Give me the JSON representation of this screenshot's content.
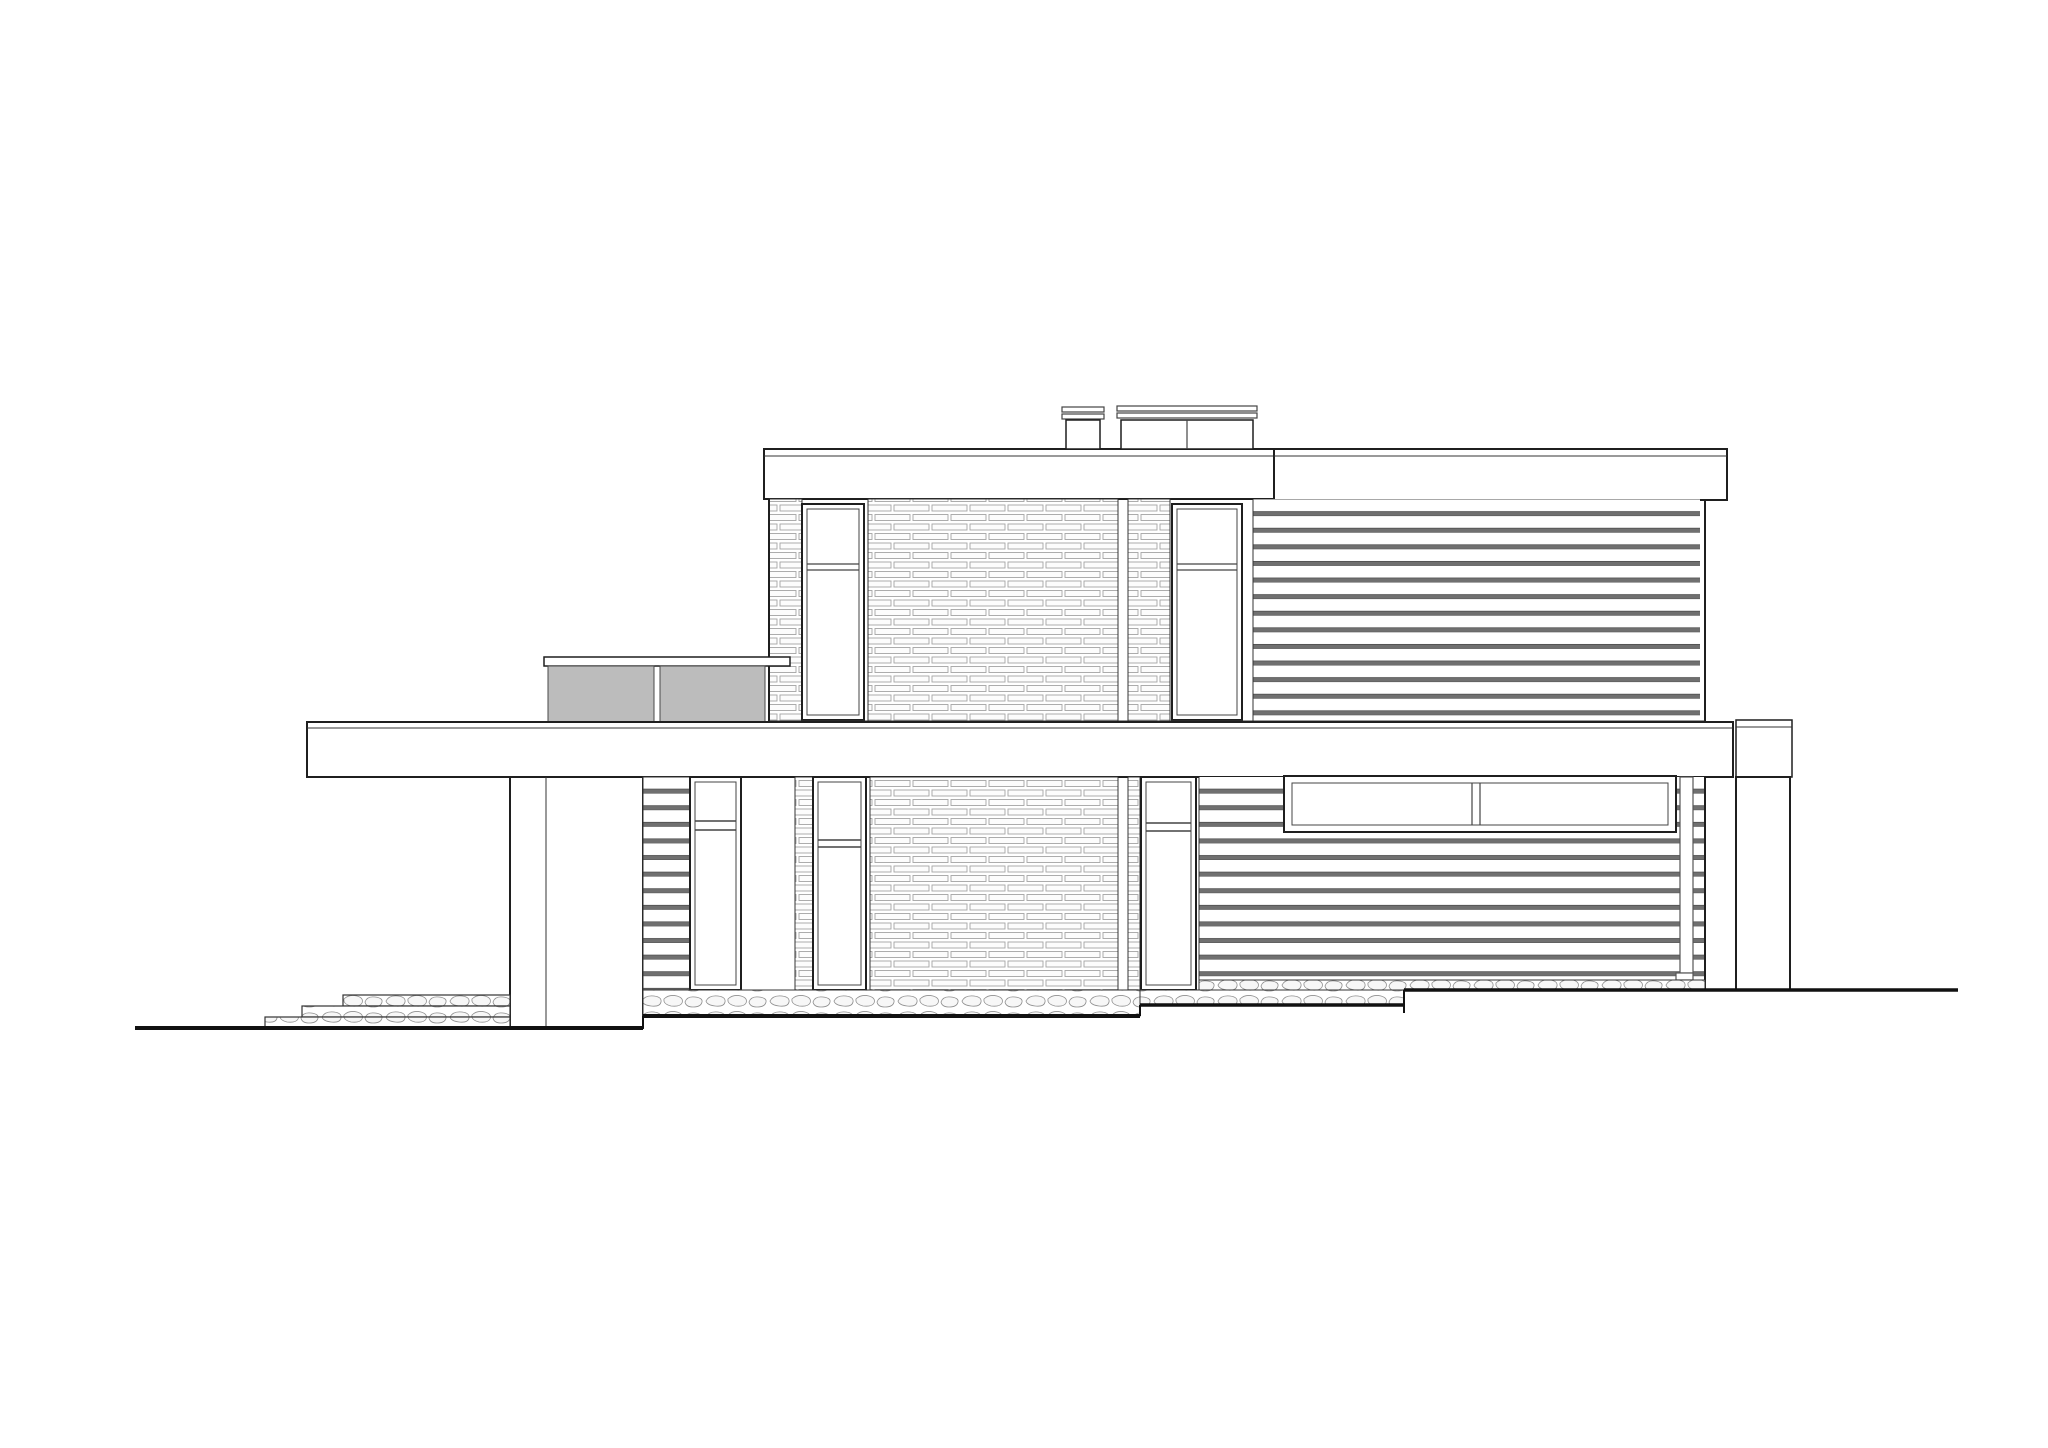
{
  "drawing": {
    "type": "architectural-elevation",
    "subject": "two-story flat-roof modern house side elevation with brick and horizontal siding facades",
    "background": "#ffffff"
  },
  "canvas": {
    "width": 2048,
    "height": 1448
  },
  "colors": {
    "white": "#ffffff",
    "none": "none",
    "dark": "#1f1f1f",
    "mid": "#444444",
    "light": "#333333",
    "pipe": "#555555",
    "ground": "#111111",
    "rail": "#bcbcbc",
    "railStroke": "#4a4a4a",
    "brickLine": "#a3a3a3",
    "brickFill": "#fcfcfc",
    "sidingBar": "#707070",
    "sidingEdge": "#3f3f3f",
    "stoneLine": "#8f8f8f"
  },
  "shapes": [
    {
      "n": "left-roof-slab",
      "t": "rect",
      "x": 764,
      "y": 449,
      "w": 510,
      "h": 50,
      "f": "white",
      "s": "dark",
      "sw": 2
    },
    {
      "n": "left-roof-edge-line",
      "t": "line",
      "x1": 764,
      "y1": 456,
      "x2": 1274,
      "y2": 456,
      "s": "light",
      "sw": 1
    },
    {
      "n": "right-roof-slab",
      "t": "rect",
      "x": 1274,
      "y": 449,
      "w": 453,
      "h": 51,
      "f": "white",
      "s": "dark",
      "sw": 2
    },
    {
      "n": "right-roof-edge-line",
      "t": "line",
      "x1": 1274,
      "y1": 456,
      "x2": 1727,
      "y2": 456,
      "s": "light",
      "sw": 1
    },
    {
      "n": "chimney-small-cap-upper",
      "t": "rect",
      "x": 1062,
      "y": 407,
      "w": 42,
      "h": 5,
      "f": "white",
      "s": "mid",
      "sw": 1.2
    },
    {
      "n": "chimney-small-cap-lower",
      "t": "rect",
      "x": 1062,
      "y": 414,
      "w": 42,
      "h": 5,
      "f": "white",
      "s": "mid",
      "sw": 1.2
    },
    {
      "n": "chimney-small-body",
      "t": "rect",
      "x": 1066,
      "y": 420,
      "w": 34,
      "h": 29,
      "f": "white",
      "s": "dark",
      "sw": 1.5
    },
    {
      "n": "chimney-wide-cap-upper",
      "t": "rect",
      "x": 1117,
      "y": 406,
      "w": 140,
      "h": 5,
      "f": "white",
      "s": "mid",
      "sw": 1.2
    },
    {
      "n": "chimney-wide-cap-lower",
      "t": "rect",
      "x": 1117,
      "y": 413,
      "w": 140,
      "h": 5,
      "f": "white",
      "s": "mid",
      "sw": 1.2
    },
    {
      "n": "chimney-wide-body",
      "t": "rect",
      "x": 1121,
      "y": 420,
      "w": 132,
      "h": 29,
      "f": "white",
      "s": "dark",
      "sw": 1.5
    },
    {
      "n": "chimney-wide-divider",
      "t": "line",
      "x1": 1187,
      "y1": 420,
      "x2": 1187,
      "y2": 449,
      "s": "mid",
      "sw": 1.2
    },
    {
      "n": "upper-wall-brick-corner-left",
      "t": "rect",
      "x": 769,
      "y": 499,
      "w": 33,
      "h": 223,
      "f": "p:brick",
      "s": "light",
      "sw": 1
    },
    {
      "n": "upper-brick-field",
      "t": "rect",
      "x": 868,
      "y": 499,
      "w": 250,
      "h": 223,
      "f": "p:brick",
      "s": "light",
      "sw": 1
    },
    {
      "n": "upper-brick-pier-narrow",
      "t": "rect",
      "x": 1128,
      "y": 499,
      "w": 42,
      "h": 223,
      "f": "p:brick",
      "s": "light",
      "sw": 1
    },
    {
      "n": "upper-window-left-frame",
      "t": "rect",
      "x": 802,
      "y": 504,
      "w": 62,
      "h": 216,
      "f": "white",
      "s": "dark",
      "sw": 2
    },
    {
      "n": "upper-window-left-inner",
      "t": "rect",
      "x": 807,
      "y": 509,
      "w": 52,
      "h": 206,
      "f": "white",
      "s": "mid",
      "sw": 1
    },
    {
      "n": "upper-window-left-transom-a",
      "t": "line",
      "x1": 807,
      "y1": 564,
      "x2": 859,
      "y2": 564,
      "s": "mid",
      "sw": 1.2
    },
    {
      "n": "upper-window-left-transom-b",
      "t": "line",
      "x1": 807,
      "y1": 570,
      "x2": 859,
      "y2": 570,
      "s": "mid",
      "sw": 1.2
    },
    {
      "n": "upper-window-right-frame",
      "t": "rect",
      "x": 1172,
      "y": 504,
      "w": 70,
      "h": 216,
      "f": "white",
      "s": "dark",
      "sw": 2
    },
    {
      "n": "upper-window-right-inner",
      "t": "rect",
      "x": 1177,
      "y": 509,
      "w": 60,
      "h": 206,
      "f": "white",
      "s": "mid",
      "sw": 1
    },
    {
      "n": "upper-window-right-transom-a",
      "t": "line",
      "x1": 1177,
      "y1": 564,
      "x2": 1237,
      "y2": 564,
      "s": "mid",
      "sw": 1.2
    },
    {
      "n": "upper-window-right-transom-b",
      "t": "line",
      "x1": 1177,
      "y1": 570,
      "x2": 1237,
      "y2": 570,
      "s": "mid",
      "sw": 1.2
    },
    {
      "n": "upper-siding-field",
      "t": "rect",
      "x": 1253,
      "y": 499,
      "w": 447,
      "h": 223,
      "f": "p:sidingU",
      "s": "none",
      "sw": 0
    },
    {
      "n": "upper-siding-left-joint",
      "t": "line",
      "x1": 1253,
      "y1": 499,
      "x2": 1253,
      "y2": 722,
      "s": "light",
      "sw": 1
    },
    {
      "n": "upper-wall-left-edge",
      "t": "line",
      "x1": 769,
      "y1": 499,
      "x2": 769,
      "y2": 722,
      "s": "dark",
      "sw": 2
    },
    {
      "n": "upper-wall-right-edge",
      "t": "line",
      "x1": 1705,
      "y1": 499,
      "x2": 1705,
      "y2": 722,
      "s": "dark",
      "sw": 2
    },
    {
      "n": "upper-wall-bottom-line",
      "t": "line",
      "x1": 769,
      "y1": 721,
      "x2": 1705,
      "y2": 721,
      "s": "light",
      "sw": 1
    },
    {
      "n": "terrace-rail-top-bar",
      "t": "rect",
      "x": 544,
      "y": 657,
      "w": 246,
      "h": 9,
      "f": "white",
      "s": "dark",
      "sw": 1.5
    },
    {
      "n": "terrace-rail-panel-left",
      "t": "rect",
      "x": 548,
      "y": 666,
      "w": 106,
      "h": 56,
      "f": "rail",
      "s": "railStroke",
      "sw": 1
    },
    {
      "n": "terrace-rail-panel-right",
      "t": "rect",
      "x": 660,
      "y": 666,
      "w": 105,
      "h": 56,
      "f": "rail",
      "s": "railStroke",
      "sw": 1
    },
    {
      "n": "mid-floor-slab",
      "t": "rect",
      "x": 307,
      "y": 722,
      "w": 1426,
      "h": 55,
      "f": "white",
      "s": "dark",
      "sw": 2
    },
    {
      "n": "mid-floor-slab-top-line",
      "t": "line",
      "x1": 307,
      "y1": 728,
      "x2": 1733,
      "y2": 728,
      "s": "light",
      "sw": 1
    },
    {
      "n": "mid-floor-slab-right-piece",
      "t": "rect",
      "x": 1736,
      "y": 720,
      "w": 56,
      "h": 57,
      "f": "white",
      "s": "dark",
      "sw": 1.5
    },
    {
      "n": "mid-floor-slab-right-line",
      "t": "line",
      "x1": 1736,
      "y1": 727,
      "x2": 1792,
      "y2": 727,
      "s": "light",
      "sw": 1
    },
    {
      "n": "lower-pier-left",
      "t": "rect",
      "x": 510,
      "y": 777,
      "w": 133,
      "h": 251,
      "f": "white",
      "s": "dark",
      "sw": 2
    },
    {
      "n": "lower-pier-left-corner",
      "t": "line",
      "x1": 546,
      "y1": 777,
      "x2": 546,
      "y2": 1028,
      "s": "light",
      "sw": 1
    },
    {
      "n": "lower-siding-strip",
      "t": "rect",
      "x": 643,
      "y": 777,
      "w": 47,
      "h": 213,
      "f": "p:sidingL",
      "s": "light",
      "sw": 1
    },
    {
      "n": "lower-window-a-frame",
      "t": "rect",
      "x": 690,
      "y": 777,
      "w": 51,
      "h": 213,
      "f": "white",
      "s": "dark",
      "sw": 2
    },
    {
      "n": "lower-window-a-inner",
      "t": "rect",
      "x": 695,
      "y": 782,
      "w": 41,
      "h": 203,
      "f": "white",
      "s": "mid",
      "sw": 1
    },
    {
      "n": "lower-window-a-transom-a",
      "t": "line",
      "x1": 695,
      "y1": 821,
      "x2": 736,
      "y2": 821,
      "s": "mid",
      "sw": 1.5
    },
    {
      "n": "lower-window-a-transom-b",
      "t": "line",
      "x1": 695,
      "y1": 830,
      "x2": 736,
      "y2": 830,
      "s": "mid",
      "sw": 1.5
    },
    {
      "n": "lower-brick-pier-a",
      "t": "rect",
      "x": 795,
      "y": 777,
      "w": 18,
      "h": 213,
      "f": "p:brick",
      "s": "light",
      "sw": 1
    },
    {
      "n": "lower-window-b-frame",
      "t": "rect",
      "x": 813,
      "y": 777,
      "w": 53,
      "h": 213,
      "f": "white",
      "s": "dark",
      "sw": 2
    },
    {
      "n": "lower-window-b-inner",
      "t": "rect",
      "x": 818,
      "y": 782,
      "w": 43,
      "h": 203,
      "f": "white",
      "s": "mid",
      "sw": 1
    },
    {
      "n": "lower-window-b-transom-a",
      "t": "line",
      "x1": 818,
      "y1": 840,
      "x2": 861,
      "y2": 840,
      "s": "mid",
      "sw": 1.5
    },
    {
      "n": "lower-window-b-transom-b",
      "t": "line",
      "x1": 818,
      "y1": 847,
      "x2": 861,
      "y2": 847,
      "s": "mid",
      "sw": 1.5
    },
    {
      "n": "lower-brick-field",
      "t": "rect",
      "x": 870,
      "y": 777,
      "w": 248,
      "h": 213,
      "f": "p:brick",
      "s": "light",
      "sw": 1
    },
    {
      "n": "lower-brick-pier-b",
      "t": "rect",
      "x": 1128,
      "y": 777,
      "w": 12,
      "h": 213,
      "f": "p:brick",
      "s": "light",
      "sw": 1
    },
    {
      "n": "lower-window-c-frame",
      "t": "rect",
      "x": 1141,
      "y": 777,
      "w": 55,
      "h": 213,
      "f": "white",
      "s": "dark",
      "sw": 2
    },
    {
      "n": "lower-window-c-inner",
      "t": "rect",
      "x": 1146,
      "y": 782,
      "w": 45,
      "h": 203,
      "f": "white",
      "s": "mid",
      "sw": 1
    },
    {
      "n": "lower-window-c-transom-a",
      "t": "line",
      "x1": 1146,
      "y1": 823,
      "x2": 1191,
      "y2": 823,
      "s": "mid",
      "sw": 1.5
    },
    {
      "n": "lower-window-c-transom-b",
      "t": "line",
      "x1": 1146,
      "y1": 831,
      "x2": 1191,
      "y2": 831,
      "s": "mid",
      "sw": 1.5
    },
    {
      "n": "lower-siding-field",
      "t": "rect",
      "x": 1199,
      "y": 777,
      "w": 506,
      "h": 203,
      "f": "p:sidingL",
      "s": "none",
      "sw": 0
    },
    {
      "n": "lower-siding-left-joint",
      "t": "line",
      "x1": 1199,
      "y1": 777,
      "x2": 1199,
      "y2": 980,
      "s": "light",
      "sw": 1
    },
    {
      "n": "ribbon-window-frame",
      "t": "rect",
      "x": 1284,
      "y": 776,
      "w": 392,
      "h": 56,
      "f": "white",
      "s": "dark",
      "sw": 2
    },
    {
      "n": "ribbon-window-inner",
      "t": "rect",
      "x": 1292,
      "y": 783,
      "w": 376,
      "h": 42,
      "f": "white",
      "s": "mid",
      "sw": 1
    },
    {
      "n": "ribbon-window-mullion-a",
      "t": "line",
      "x1": 1472,
      "y1": 783,
      "x2": 1472,
      "y2": 825,
      "s": "mid",
      "sw": 1.2
    },
    {
      "n": "ribbon-window-mullion-b",
      "t": "line",
      "x1": 1480,
      "y1": 783,
      "x2": 1480,
      "y2": 825,
      "s": "mid",
      "sw": 1.2
    },
    {
      "n": "downspout",
      "t": "rect",
      "x": 1680,
      "y": 777,
      "w": 13,
      "h": 196,
      "f": "white",
      "s": "pipe",
      "sw": 1.2
    },
    {
      "n": "downspout-shoe",
      "t": "rect",
      "x": 1676,
      "y": 973,
      "w": 17,
      "h": 7,
      "f": "white",
      "s": "pipe",
      "sw": 1.2
    },
    {
      "n": "lower-wall-right-edge",
      "t": "line",
      "x1": 1705,
      "y1": 777,
      "x2": 1705,
      "y2": 990,
      "s": "dark",
      "sw": 2
    },
    {
      "n": "lower-pier-right",
      "t": "rect",
      "x": 1736,
      "y": 777,
      "w": 54,
      "h": 213,
      "f": "white",
      "s": "dark",
      "sw": 2
    },
    {
      "n": "stone-base-mid-left",
      "t": "rect",
      "x": 643,
      "y": 990,
      "w": 497,
      "h": 26,
      "f": "p:stone",
      "s": "light",
      "sw": 1
    },
    {
      "n": "stone-base-mid-right",
      "t": "rect",
      "x": 1140,
      "y": 990,
      "w": 264,
      "h": 15,
      "f": "p:stone",
      "s": "light",
      "sw": 1
    },
    {
      "n": "stone-base-right",
      "t": "rect",
      "x": 1199,
      "y": 980,
      "w": 506,
      "h": 10,
      "f": "p:stone",
      "s": "light",
      "sw": 1
    },
    {
      "n": "terrace-step-top",
      "t": "rect",
      "x": 343,
      "y": 995,
      "w": 167,
      "h": 11,
      "f": "p:stone",
      "s": "light",
      "sw": 1.2
    },
    {
      "n": "terrace-step-middle",
      "t": "rect",
      "x": 302,
      "y": 1006,
      "w": 208,
      "h": 11,
      "f": "p:stone",
      "s": "light",
      "sw": 1.2
    },
    {
      "n": "terrace-step-bottom",
      "t": "rect",
      "x": 265,
      "y": 1017,
      "w": 245,
      "h": 11,
      "f": "p:stone",
      "s": "light",
      "sw": 1.2
    },
    {
      "n": "ground-line-left",
      "t": "line",
      "x1": 135,
      "y1": 1028,
      "x2": 643,
      "y2": 1028,
      "s": "ground",
      "sw": 4
    },
    {
      "n": "ground-step-a",
      "t": "line",
      "x1": 643,
      "y1": 1016,
      "x2": 643,
      "y2": 1028,
      "s": "ground",
      "sw": 2
    },
    {
      "n": "ground-line-mid-left",
      "t": "line",
      "x1": 643,
      "y1": 1016,
      "x2": 1140,
      "y2": 1016,
      "s": "ground",
      "sw": 4
    },
    {
      "n": "ground-step-b",
      "t": "line",
      "x1": 1140,
      "y1": 1005,
      "x2": 1140,
      "y2": 1016,
      "s": "ground",
      "sw": 2
    },
    {
      "n": "ground-line-mid-right",
      "t": "line",
      "x1": 1140,
      "y1": 1005,
      "x2": 1404,
      "y2": 1005,
      "s": "ground",
      "sw": 3.5
    },
    {
      "n": "ground-step-c",
      "t": "line",
      "x1": 1404,
      "y1": 990,
      "x2": 1404,
      "y2": 1013,
      "s": "ground",
      "sw": 2
    },
    {
      "n": "ground-line-right",
      "t": "line",
      "x1": 1404,
      "y1": 990,
      "x2": 1958,
      "y2": 990,
      "s": "ground",
      "sw": 3.5
    }
  ]
}
